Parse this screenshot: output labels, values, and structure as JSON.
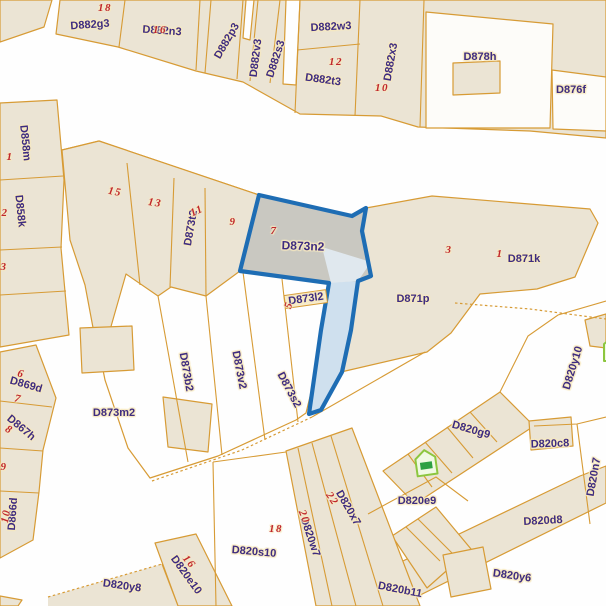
{
  "map": {
    "highlight": {
      "parcel": "D873n2",
      "number": "7"
    },
    "labels": {
      "d882g3": "D882g3",
      "d882n3": "D882n3",
      "d882p3": "D882p3",
      "d882v3": "D882v3",
      "d882s3": "D882s3",
      "d882w3": "D882w3",
      "d882t3": "D882t3",
      "d882x3": "D882x3",
      "d878h": "D878h",
      "d876f": "D876f",
      "d858m": "D858m",
      "d858k": "D858k",
      "d869d": "D869d",
      "d867h": "D867h",
      "d866d": "D866d",
      "d873t2": "D873t2",
      "d873n2": "D873n2",
      "d873l2": "D873l2",
      "d873m2": "D873m2",
      "d873b2": "D873b2",
      "d873v2": "D873v2",
      "d873s2": "D873s2",
      "d871p": "D871p",
      "d871k": "D871k",
      "d820y10": "D820y10",
      "d820g9": "D820g9",
      "d820c8": "D820c8",
      "d820n7": "D820n7",
      "d820e9": "D820e9",
      "d820d8": "D820d8",
      "d820y6": "D820y6",
      "d820b11": "D820b11",
      "d820y8": "D820y8",
      "d820s10": "D820s10",
      "d820e10": "D820e10",
      "d820w7": "D820w7",
      "d820x7": "D820x7"
    },
    "numbers": {
      "n18t": "18",
      "n16t": "16",
      "n12t": "12",
      "n10t": "10",
      "n15": "15",
      "n13": "13",
      "n11": "11",
      "n9": "9",
      "n7": "7",
      "n3r": "3",
      "n1r": "1",
      "n1l": "1",
      "n2l": "2",
      "n3l": "3",
      "n6l": "6",
      "n7l": "7",
      "n8l": "8",
      "n9l": "9",
      "n10l": "10",
      "n5m": "5",
      "n16b": "16",
      "n18b": "18",
      "n20b": "20",
      "n22b": "22"
    },
    "colors": {
      "parcel_fill": "#ebe4d4",
      "boundary": "#d79b35",
      "label_text": "#3e2c80",
      "number_text": "#c0262c",
      "road": "#fefefe",
      "highlight_stroke": "#1e6db4",
      "highlight_fill": "#c9c8c1",
      "green_icon": "#2da043"
    }
  }
}
